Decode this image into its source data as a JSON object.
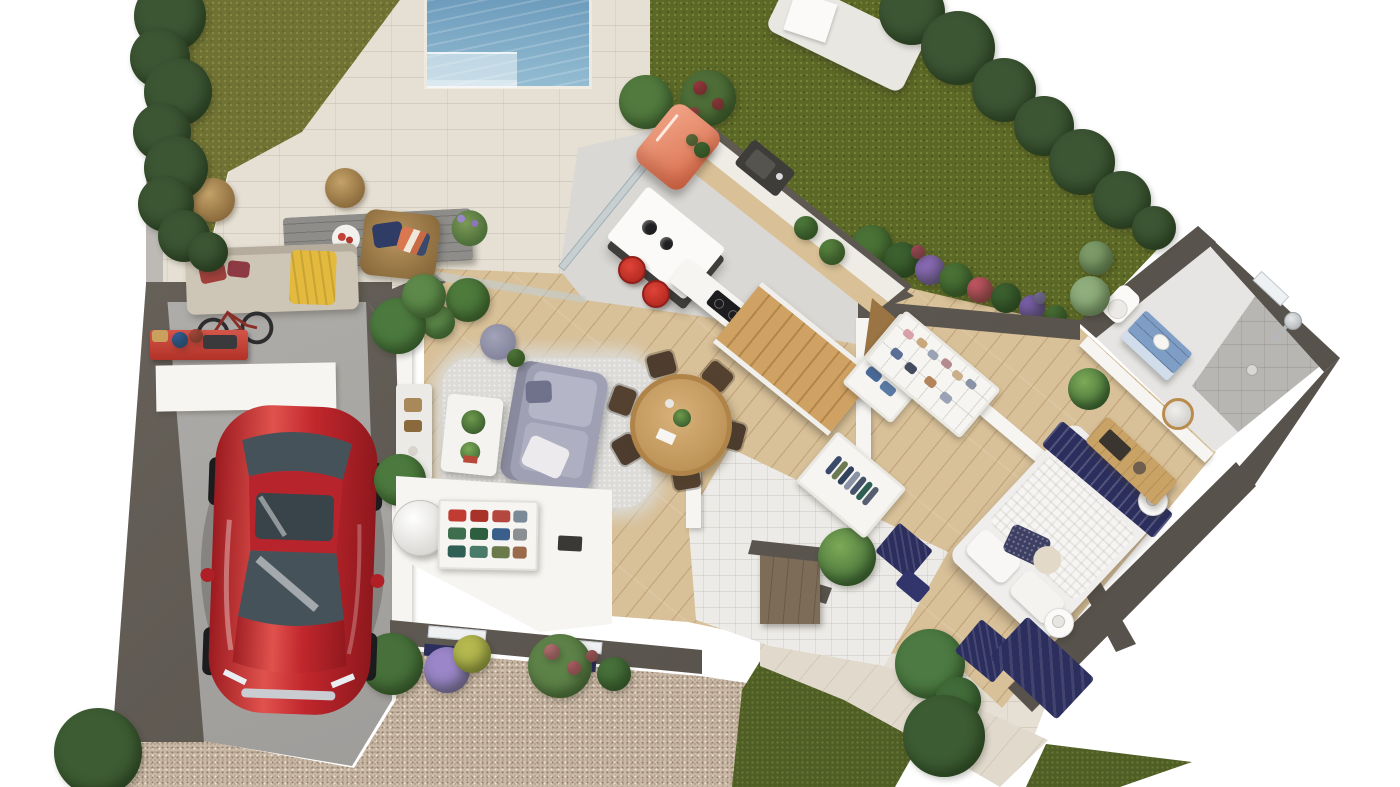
{
  "meta": {
    "scene": "floor-plan-3d-render",
    "view": "top-down-dollhouse",
    "canvas_w": 1400,
    "canvas_h": 787,
    "visible_text": "none"
  },
  "palette": {
    "bg": "#ffffff",
    "wallDark": "#57524b",
    "wallSide": "#6b655e",
    "wallWhite": "#f6f5f2",
    "lawnL": "#6f7233",
    "lawnR": "#5c6826",
    "grassDark": "#4f5e25",
    "hedge": "#3c5533",
    "tree": "#3f5e36",
    "poolTop": "#6d9cbc",
    "poolBottom": "#93bcd2",
    "poolStep": "#c2d9e2",
    "patio": "#e6e0d4",
    "walkway": "#e0d9cc",
    "wood": "#d8c098",
    "kitchenFloor": "#dad8d4",
    "entryFloor": "#edebe7",
    "bathFloor": "#e6e5e3",
    "shower": "#b7b6b3",
    "gravel": "#c9b8a6",
    "carRed": "#c1272d",
    "carGlass": "#46525a",
    "fridge": "#e2795b",
    "stool": "#d5382e",
    "stairs": "#c49a5e",
    "diningTable": "#c59f63",
    "sofaOutdoor": "#cdc5b6",
    "sofaLavender": "#9fa0b4",
    "rug": "#dcdbd8",
    "navy": "#2c2f5e",
    "vanityBlue": "#7f9ec6",
    "benchWood": "#c9a266",
    "stoneWall": "#75644e",
    "workbenchRed": "#c23f33",
    "rattan": "#a9895a",
    "yellowThrow": "#e3b93e",
    "islandBase": "#403e3b"
  },
  "inventory": {
    "outdoor": [
      "hedge",
      "lawn",
      "swimming-pool",
      "pool-deck",
      "sun-lounger",
      "terrace",
      "outdoor-sofa",
      "outdoor-coffee-table",
      "rattan-armchair",
      "rattan-poufs",
      "gravel-driveway",
      "flower-beds",
      "walkway",
      "monstera-plant",
      "bushes"
    ],
    "garage": [
      "red-coupe-car",
      "wall-bike",
      "red-workbench",
      "buckets",
      "toolbox",
      "white-panel"
    ],
    "kitchen": [
      "retro-fridge",
      "wall-counter-with-sink",
      "island-with-pendants",
      "red-bar-stools",
      "peninsula-with-hob",
      "staircase"
    ],
    "living": [
      "lavender-sofa",
      "shag-rug",
      "white-coffee-table",
      "potted-plants",
      "pouf",
      "media-console",
      "palm-plants"
    ],
    "dining": [
      "round-wood-table",
      "six-chairs"
    ],
    "utility": [
      "water-heater-cylinder",
      "storage-shelf-with-bins",
      "built-in-cabinet"
    ],
    "entry": [
      "stone-accent-wall",
      "coat-closet",
      "indoor-plant",
      "navy-mats"
    ],
    "dressing": [
      "hanging-rail-unit",
      "cubby-shelf-unit"
    ],
    "bedroom": [
      "double-bed",
      "navy-throw",
      "bedside-tables",
      "wood-bench-with-tv",
      "round-mirror",
      "navy-rug",
      "plant"
    ],
    "bathroom": [
      "toilet",
      "blue-vanity",
      "walk-in-shower",
      "shower-column",
      "window"
    ]
  },
  "scatter": {
    "hedgeLeft": [
      {
        "x": 170,
        "y": 16,
        "s": 72
      },
      {
        "x": 160,
        "y": 58,
        "s": 60
      },
      {
        "x": 178,
        "y": 92,
        "s": 68
      },
      {
        "x": 162,
        "y": 132,
        "s": 58
      },
      {
        "x": 176,
        "y": 168,
        "s": 64
      },
      {
        "x": 166,
        "y": 204,
        "s": 56
      },
      {
        "x": 184,
        "y": 236,
        "s": 52
      },
      {
        "x": 208,
        "y": 252,
        "s": 40
      }
    ],
    "treesTopRight": [
      {
        "x": 912,
        "y": 12,
        "s": 66
      },
      {
        "x": 958,
        "y": 48,
        "s": 74
      },
      {
        "x": 1004,
        "y": 90,
        "s": 64
      },
      {
        "x": 1044,
        "y": 126,
        "s": 60
      },
      {
        "x": 1082,
        "y": 162,
        "s": 66
      },
      {
        "x": 1122,
        "y": 200,
        "s": 58
      },
      {
        "x": 1154,
        "y": 228,
        "s": 44
      },
      {
        "x": 1096,
        "y": 258,
        "s": 34,
        "c": "#7d9b68"
      },
      {
        "x": 1090,
        "y": 296,
        "s": 40,
        "c": "#8fae7c"
      }
    ],
    "flowerBed": [
      {
        "x": 872,
        "y": 246,
        "s": 42,
        "c": "#4a7136"
      },
      {
        "x": 902,
        "y": 260,
        "s": 36,
        "c": "#3c6030"
      },
      {
        "x": 930,
        "y": 270,
        "s": 30,
        "c": "#8a6bb5"
      },
      {
        "x": 956,
        "y": 280,
        "s": 34,
        "c": "#4a7136"
      },
      {
        "x": 980,
        "y": 290,
        "s": 26,
        "c": "#c05560"
      },
      {
        "x": 1006,
        "y": 298,
        "s": 30,
        "c": "#3c6030"
      },
      {
        "x": 1032,
        "y": 308,
        "s": 26,
        "c": "#7a5fa8"
      },
      {
        "x": 1056,
        "y": 316,
        "s": 22,
        "c": "#4a7136"
      },
      {
        "x": 918,
        "y": 252,
        "s": 14,
        "c": "#c2566a"
      },
      {
        "x": 1040,
        "y": 298,
        "s": 12,
        "c": "#9a86c8"
      }
    ],
    "gardenPlants": [
      {
        "x": 646,
        "y": 102,
        "s": 54,
        "c": "#527a3f"
      },
      {
        "x": 708,
        "y": 98,
        "s": 56,
        "c": "#4e6e38"
      },
      {
        "x": 700,
        "y": 88,
        "s": 14,
        "c": "#c0404e"
      },
      {
        "x": 718,
        "y": 104,
        "s": 12,
        "c": "#b8434d"
      },
      {
        "x": 694,
        "y": 112,
        "s": 10,
        "c": "#cc5560"
      },
      {
        "x": 98,
        "y": 752,
        "s": 88,
        "c": "#3d5c33"
      },
      {
        "x": 930,
        "y": 664,
        "s": 70,
        "c": "#4c7a42"
      },
      {
        "x": 958,
        "y": 700,
        "s": 46,
        "c": "#416b38"
      },
      {
        "x": 944,
        "y": 736,
        "s": 82,
        "c": "#3c5c33"
      },
      {
        "x": 468,
        "y": 300,
        "s": 44,
        "c": "#4e7a3c"
      },
      {
        "x": 438,
        "y": 322,
        "s": 34,
        "c": "#5d8a4a"
      }
    ],
    "drivewayFlowers": [
      {
        "x": 392,
        "y": 664,
        "s": 62,
        "c": "#47703a"
      },
      {
        "x": 447,
        "y": 670,
        "s": 46,
        "c": "#9a86c8"
      },
      {
        "x": 472,
        "y": 654,
        "s": 38,
        "c": "#b5b84e"
      },
      {
        "x": 560,
        "y": 666,
        "s": 64,
        "c": "#5d8248"
      },
      {
        "x": 552,
        "y": 652,
        "s": 16,
        "c": "#d87f86"
      },
      {
        "x": 574,
        "y": 668,
        "s": 14,
        "c": "#d8707c"
      },
      {
        "x": 592,
        "y": 656,
        "s": 12,
        "c": "#cf6a76"
      },
      {
        "x": 614,
        "y": 674,
        "s": 34,
        "c": "#47703a"
      }
    ],
    "livingPalms": [
      {
        "x": 398,
        "y": 326,
        "s": 56,
        "c": "#4c7a3e"
      },
      {
        "x": 424,
        "y": 296,
        "s": 44,
        "c": "#5d8a4a"
      },
      {
        "x": 400,
        "y": 480,
        "s": 52,
        "c": "#4c7a3e"
      },
      {
        "x": 446,
        "y": 512,
        "s": 44,
        "c": "#57823f"
      },
      {
        "x": 492,
        "y": 530,
        "s": 36,
        "c": "#5d8a4a"
      },
      {
        "x": 516,
        "y": 358,
        "s": 18,
        "c": "#57823f"
      }
    ],
    "diningChairs": [
      {
        "x": 626,
        "y": 449,
        "s": 27,
        "h": 23,
        "rot": 240,
        "c": "#4e3d2e",
        "cls": "chair"
      },
      {
        "x": 622,
        "y": 400,
        "s": 27,
        "h": 23,
        "rot": 290,
        "c": "#55412f",
        "cls": "chair"
      },
      {
        "x": 661,
        "y": 364,
        "s": 27,
        "h": 23,
        "rot": 345,
        "c": "#4e3d2e",
        "cls": "chair"
      },
      {
        "x": 717,
        "y": 376,
        "s": 27,
        "h": 23,
        "rot": 40,
        "c": "#55412f",
        "cls": "chair"
      },
      {
        "x": 732,
        "y": 435,
        "s": 27,
        "h": 23,
        "rot": 105,
        "c": "#4e3d2e",
        "cls": "chair"
      },
      {
        "x": 686,
        "y": 477,
        "s": 27,
        "h": 23,
        "rot": 170,
        "c": "#55412f",
        "cls": "chair"
      }
    ],
    "counterItems": [
      {
        "x": 806,
        "y": 228,
        "s": 24,
        "c": "#4e7a3c"
      },
      {
        "x": 832,
        "y": 252,
        "s": 26,
        "c": "#57823f"
      },
      {
        "x": 702,
        "y": 150,
        "s": 16,
        "c": "#4e7a3c"
      },
      {
        "x": 692,
        "y": 140,
        "s": 12,
        "c": "#7a8a50"
      }
    ],
    "closetClothes": [
      {
        "x": 16,
        "y": 26,
        "s": 6,
        "h": 22,
        "c": "#3a4a6b",
        "cls": "sq"
      },
      {
        "x": 24,
        "y": 26,
        "s": 6,
        "h": 22,
        "c": "#6b7a52",
        "cls": "sq"
      },
      {
        "x": 32,
        "y": 26,
        "s": 6,
        "h": 22,
        "c": "#31425e",
        "cls": "sq"
      },
      {
        "x": 40,
        "y": 26,
        "s": 6,
        "h": 22,
        "c": "#8a93a5",
        "cls": "sq"
      },
      {
        "x": 48,
        "y": 26,
        "s": 6,
        "h": 22,
        "c": "#46526b",
        "cls": "sq"
      },
      {
        "x": 56,
        "y": 26,
        "s": 6,
        "h": 22,
        "c": "#2e5e54",
        "cls": "sq"
      },
      {
        "x": 64,
        "y": 26,
        "s": 6,
        "h": 22,
        "c": "#555f70",
        "cls": "sq"
      }
    ],
    "hangRail": [
      {
        "x": 12,
        "y": 22,
        "s": 6,
        "h": 26,
        "c": "#42526e",
        "cls": "sq"
      },
      {
        "x": 19,
        "y": 22,
        "s": 6,
        "h": 26,
        "c": "#5a6a86",
        "cls": "sq"
      },
      {
        "x": 26,
        "y": 22,
        "s": 6,
        "h": 26,
        "c": "#394a66",
        "cls": "sq"
      },
      {
        "x": 33,
        "y": 22,
        "s": 6,
        "h": 26,
        "c": "#6e7a8e",
        "cls": "sq"
      },
      {
        "x": 40,
        "y": 22,
        "s": 6,
        "h": 26,
        "c": "#2e3e5a",
        "cls": "sq"
      },
      {
        "x": 47,
        "y": 22,
        "s": 6,
        "h": 26,
        "c": "#8a93a3",
        "cls": "sq"
      },
      {
        "x": 16,
        "y": 62,
        "s": 16,
        "h": 10,
        "c": "#4a6a9a",
        "cls": "sq"
      },
      {
        "x": 36,
        "y": 64,
        "s": 16,
        "h": 10,
        "c": "#5a7aa6",
        "cls": "sq"
      }
    ],
    "cubbyItems": [
      {
        "x": 14,
        "y": 14,
        "s": 11,
        "h": 8,
        "c": "#d8a0a8",
        "cls": "sq"
      },
      {
        "x": 30,
        "y": 12,
        "s": 11,
        "h": 8,
        "c": "#c9a87c",
        "cls": "sq"
      },
      {
        "x": 46,
        "y": 14,
        "s": 11,
        "h": 8,
        "c": "#9aa3b5",
        "cls": "sq"
      },
      {
        "x": 62,
        "y": 12,
        "s": 11,
        "h": 8,
        "c": "#b58a8f",
        "cls": "sq"
      },
      {
        "x": 78,
        "y": 14,
        "s": 11,
        "h": 8,
        "c": "#c9b08a",
        "cls": "sq"
      },
      {
        "x": 94,
        "y": 12,
        "s": 11,
        "h": 8,
        "c": "#8a93a5",
        "cls": "sq"
      },
      {
        "x": 18,
        "y": 36,
        "s": 12,
        "h": 9,
        "c": "#5a6e96",
        "cls": "sq"
      },
      {
        "x": 38,
        "y": 38,
        "s": 12,
        "h": 9,
        "c": "#444c5e",
        "cls": "sq"
      },
      {
        "x": 62,
        "y": 36,
        "s": 12,
        "h": 9,
        "c": "#b5835a",
        "cls": "sq"
      },
      {
        "x": 84,
        "y": 38,
        "s": 12,
        "h": 9,
        "c": "#9aa3b5",
        "cls": "sq"
      }
    ],
    "shelfBins": [
      {
        "x": 17,
        "y": 14,
        "s": 18,
        "h": 12,
        "c": "#c23b32",
        "cls": "sq"
      },
      {
        "x": 39,
        "y": 14,
        "s": 18,
        "h": 12,
        "c": "#a8322a",
        "cls": "sq"
      },
      {
        "x": 61,
        "y": 14,
        "s": 18,
        "h": 12,
        "c": "#b5483e",
        "cls": "sq"
      },
      {
        "x": 80,
        "y": 14,
        "s": 14,
        "h": 12,
        "c": "#7a8a96",
        "cls": "sq"
      },
      {
        "x": 17,
        "y": 32,
        "s": 18,
        "h": 12,
        "c": "#3f6e4f",
        "cls": "sq"
      },
      {
        "x": 39,
        "y": 32,
        "s": 18,
        "h": 12,
        "c": "#2e5e40",
        "cls": "sq"
      },
      {
        "x": 61,
        "y": 32,
        "s": 18,
        "h": 12,
        "c": "#3a5f8a",
        "cls": "sq"
      },
      {
        "x": 80,
        "y": 32,
        "s": 14,
        "h": 12,
        "c": "#8a8f94",
        "cls": "sq"
      },
      {
        "x": 17,
        "y": 50,
        "s": 18,
        "h": 12,
        "c": "#2f5e54",
        "cls": "sq"
      },
      {
        "x": 39,
        "y": 50,
        "s": 18,
        "h": 12,
        "c": "#4a7a6a",
        "cls": "sq"
      },
      {
        "x": 61,
        "y": 50,
        "s": 18,
        "h": 12,
        "c": "#6a7a4a",
        "cls": "sq"
      },
      {
        "x": 80,
        "y": 50,
        "s": 14,
        "h": 12,
        "c": "#9a6a4a",
        "cls": "sq"
      }
    ],
    "benchItems": [
      {
        "x": 160,
        "y": 336,
        "s": 16,
        "h": 12,
        "c": "#c9a05c",
        "cls": "sq"
      },
      {
        "x": 180,
        "y": 340,
        "s": 16,
        "c": "#3a6bb0"
      },
      {
        "x": 196,
        "y": 336,
        "s": 14,
        "c": "#d0544a"
      },
      {
        "x": 220,
        "y": 342,
        "s": 34,
        "h": 14,
        "c": "#3a3a3c",
        "cls": "sq"
      }
    ]
  }
}
